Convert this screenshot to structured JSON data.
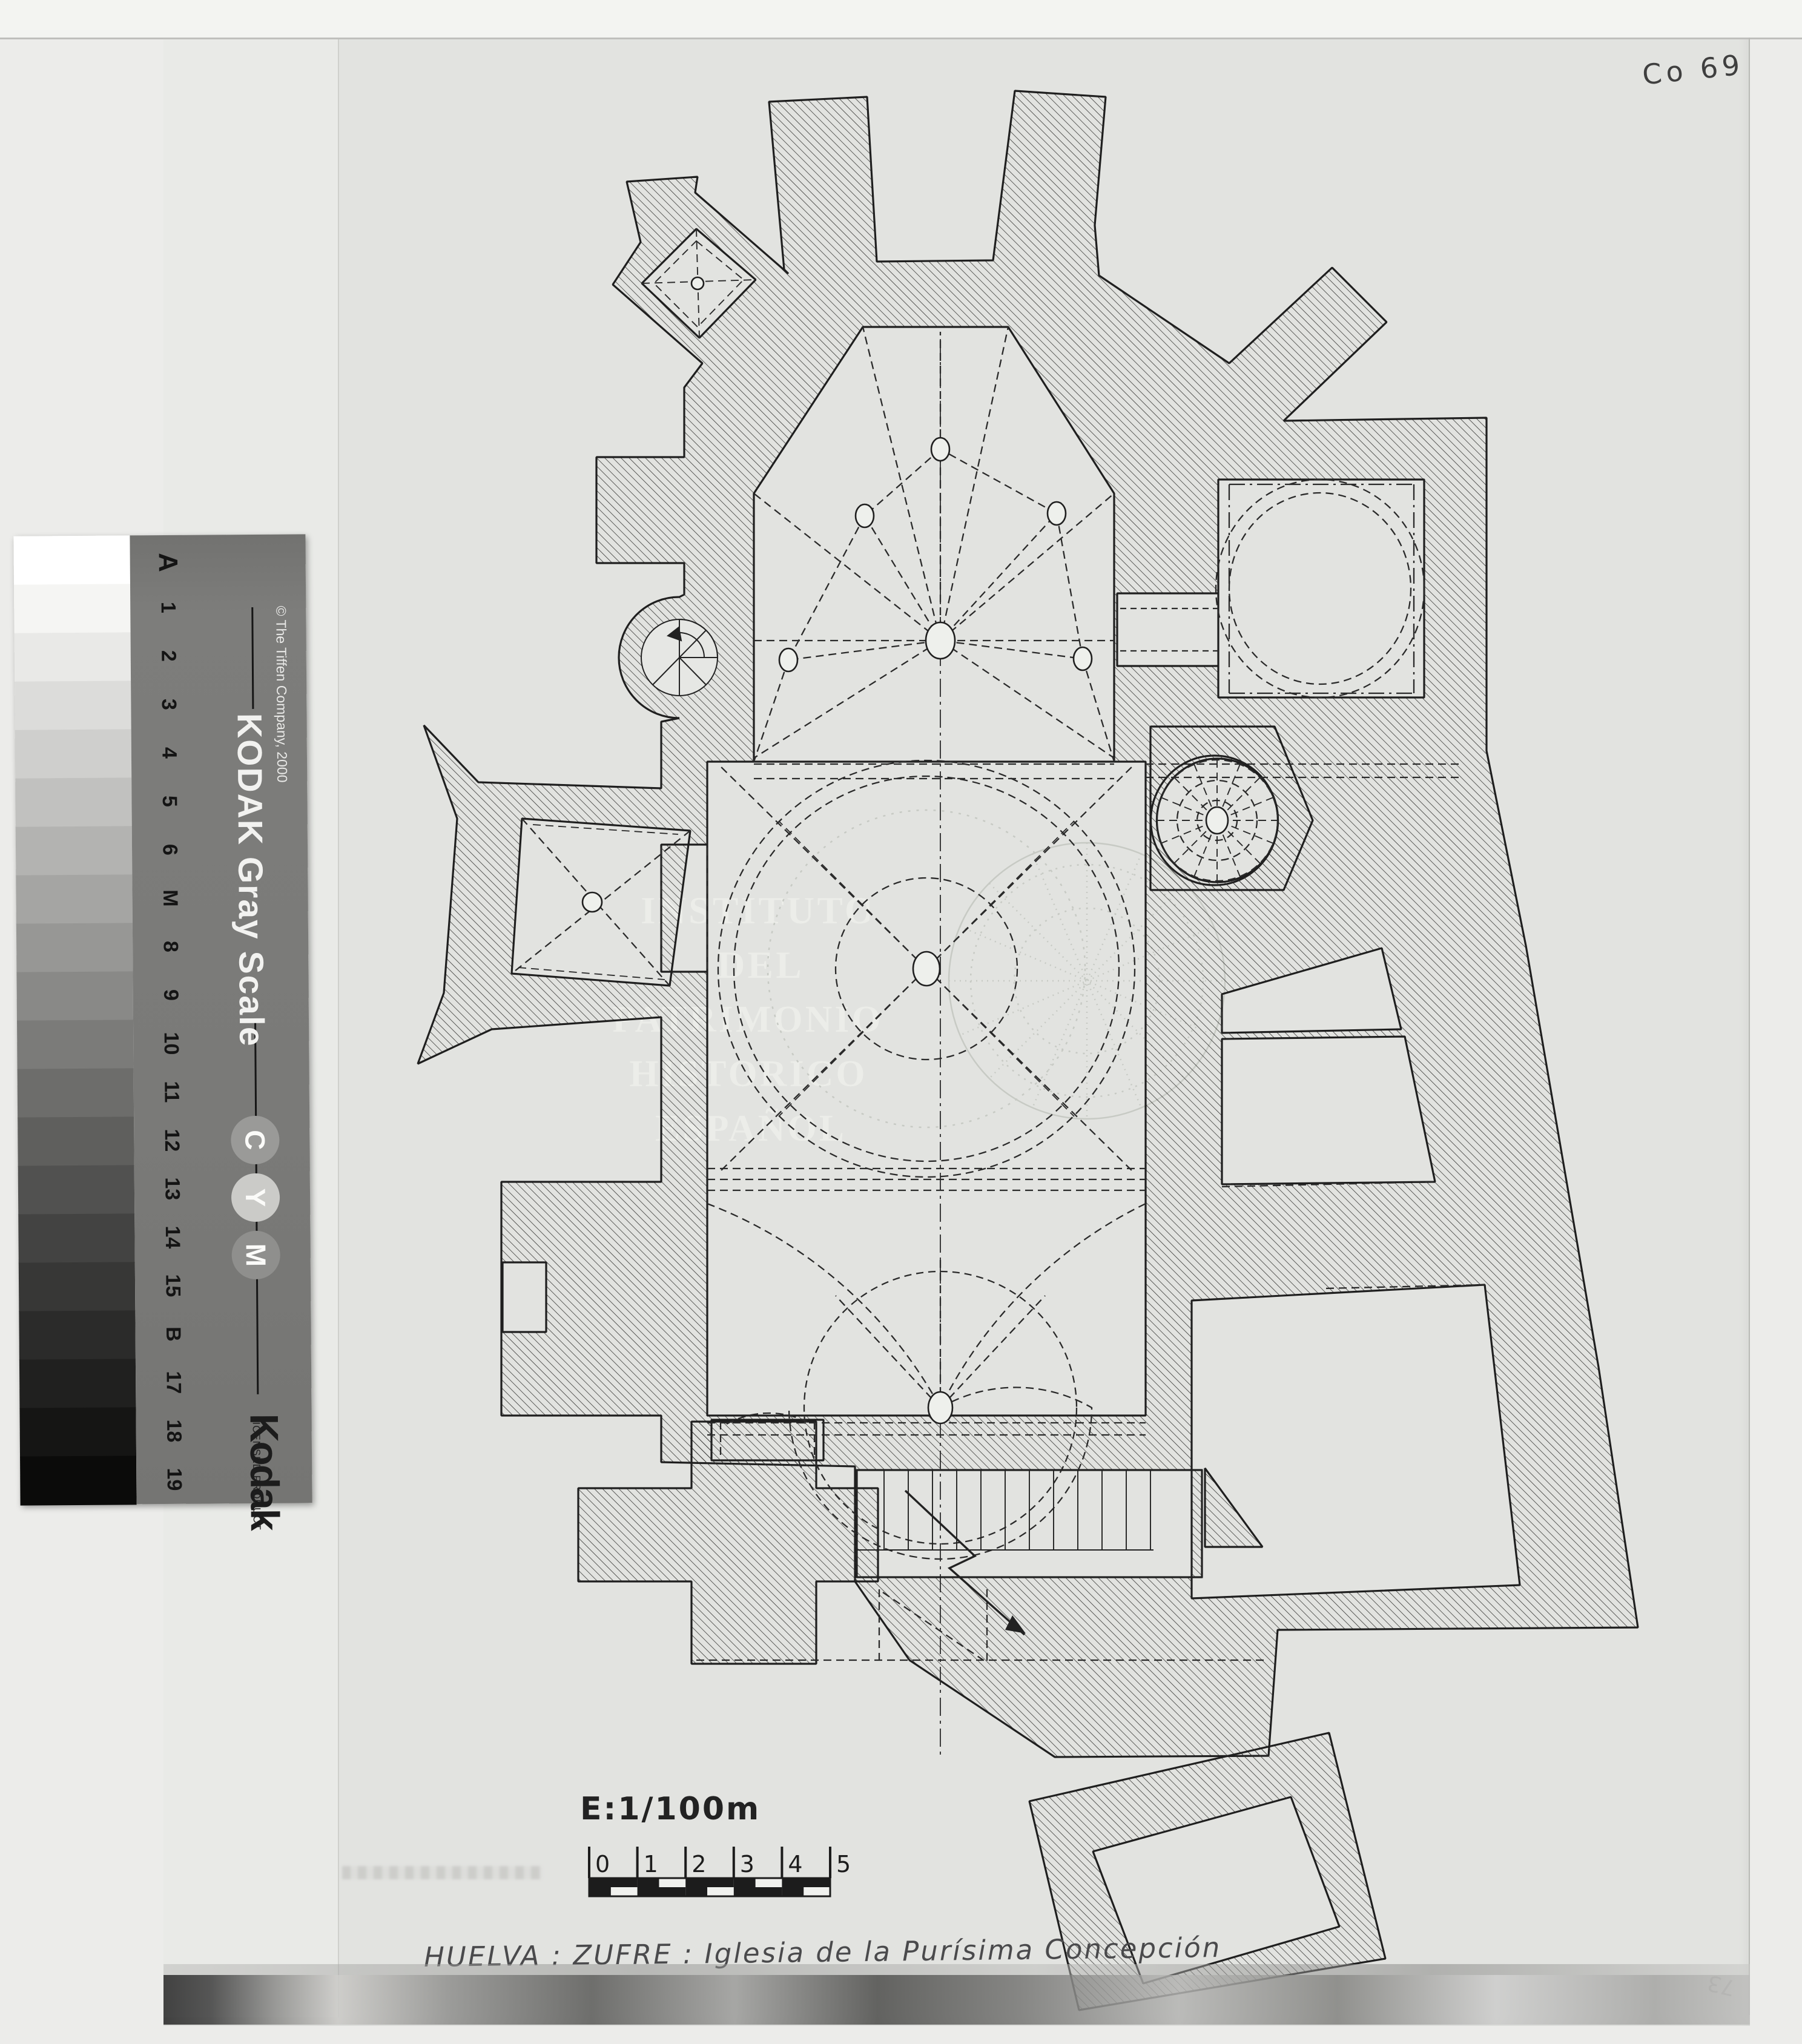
{
  "annotations": {
    "archive_code": "Co 69",
    "corner_mark": "73"
  },
  "kodak_strip": {
    "title": "KODAK Gray Scale",
    "copyright": "© The Tiffen Company, 2000",
    "logo": "Kodak",
    "licensed_line": "LICENSED PRODUCT",
    "step_labels": [
      "A",
      "1",
      "2",
      "3",
      "4",
      "5",
      "6",
      "M",
      "8",
      "9",
      "10",
      "11",
      "12",
      "13",
      "14",
      "15",
      "B",
      "17",
      "18",
      "19"
    ],
    "cmy_letters": [
      "C",
      "Y",
      "M"
    ],
    "cmy_circle_grays": [
      "#9a9a98",
      "#cbcbc8",
      "#8f8f8d"
    ],
    "patch_grays": [
      "#ffffff",
      "#f5f5f3",
      "#e9e9e7",
      "#dcdcda",
      "#cfcfcd",
      "#c1c1bf",
      "#b3b3b1",
      "#a5a5a3",
      "#979795",
      "#898987",
      "#7b7b79",
      "#6d6d6b",
      "#5f5f5d",
      "#515150",
      "#434342",
      "#373736",
      "#2b2b2a",
      "#20201f",
      "#151514",
      "#0b0b0a"
    ]
  },
  "watermark": {
    "lines": [
      "INSTITUTO",
      "DEL",
      "PATRIMONIO",
      "HISTORICO",
      "ESPAÑOL"
    ],
    "logo": "IPH"
  },
  "scale_note": {
    "label": "E:1/100m",
    "tick_labels": [
      "0",
      "1",
      "2",
      "3",
      "4",
      "5"
    ]
  },
  "caption": {
    "text": "HUELVA : ZUFRE : Iglesia de la Purísima Concepción"
  },
  "drawing": {
    "subject": "church floor plan",
    "ink_color": "#1f1f1f",
    "paper_color": "#e2e3e0",
    "watermark_gray": "#d0d3ce"
  }
}
